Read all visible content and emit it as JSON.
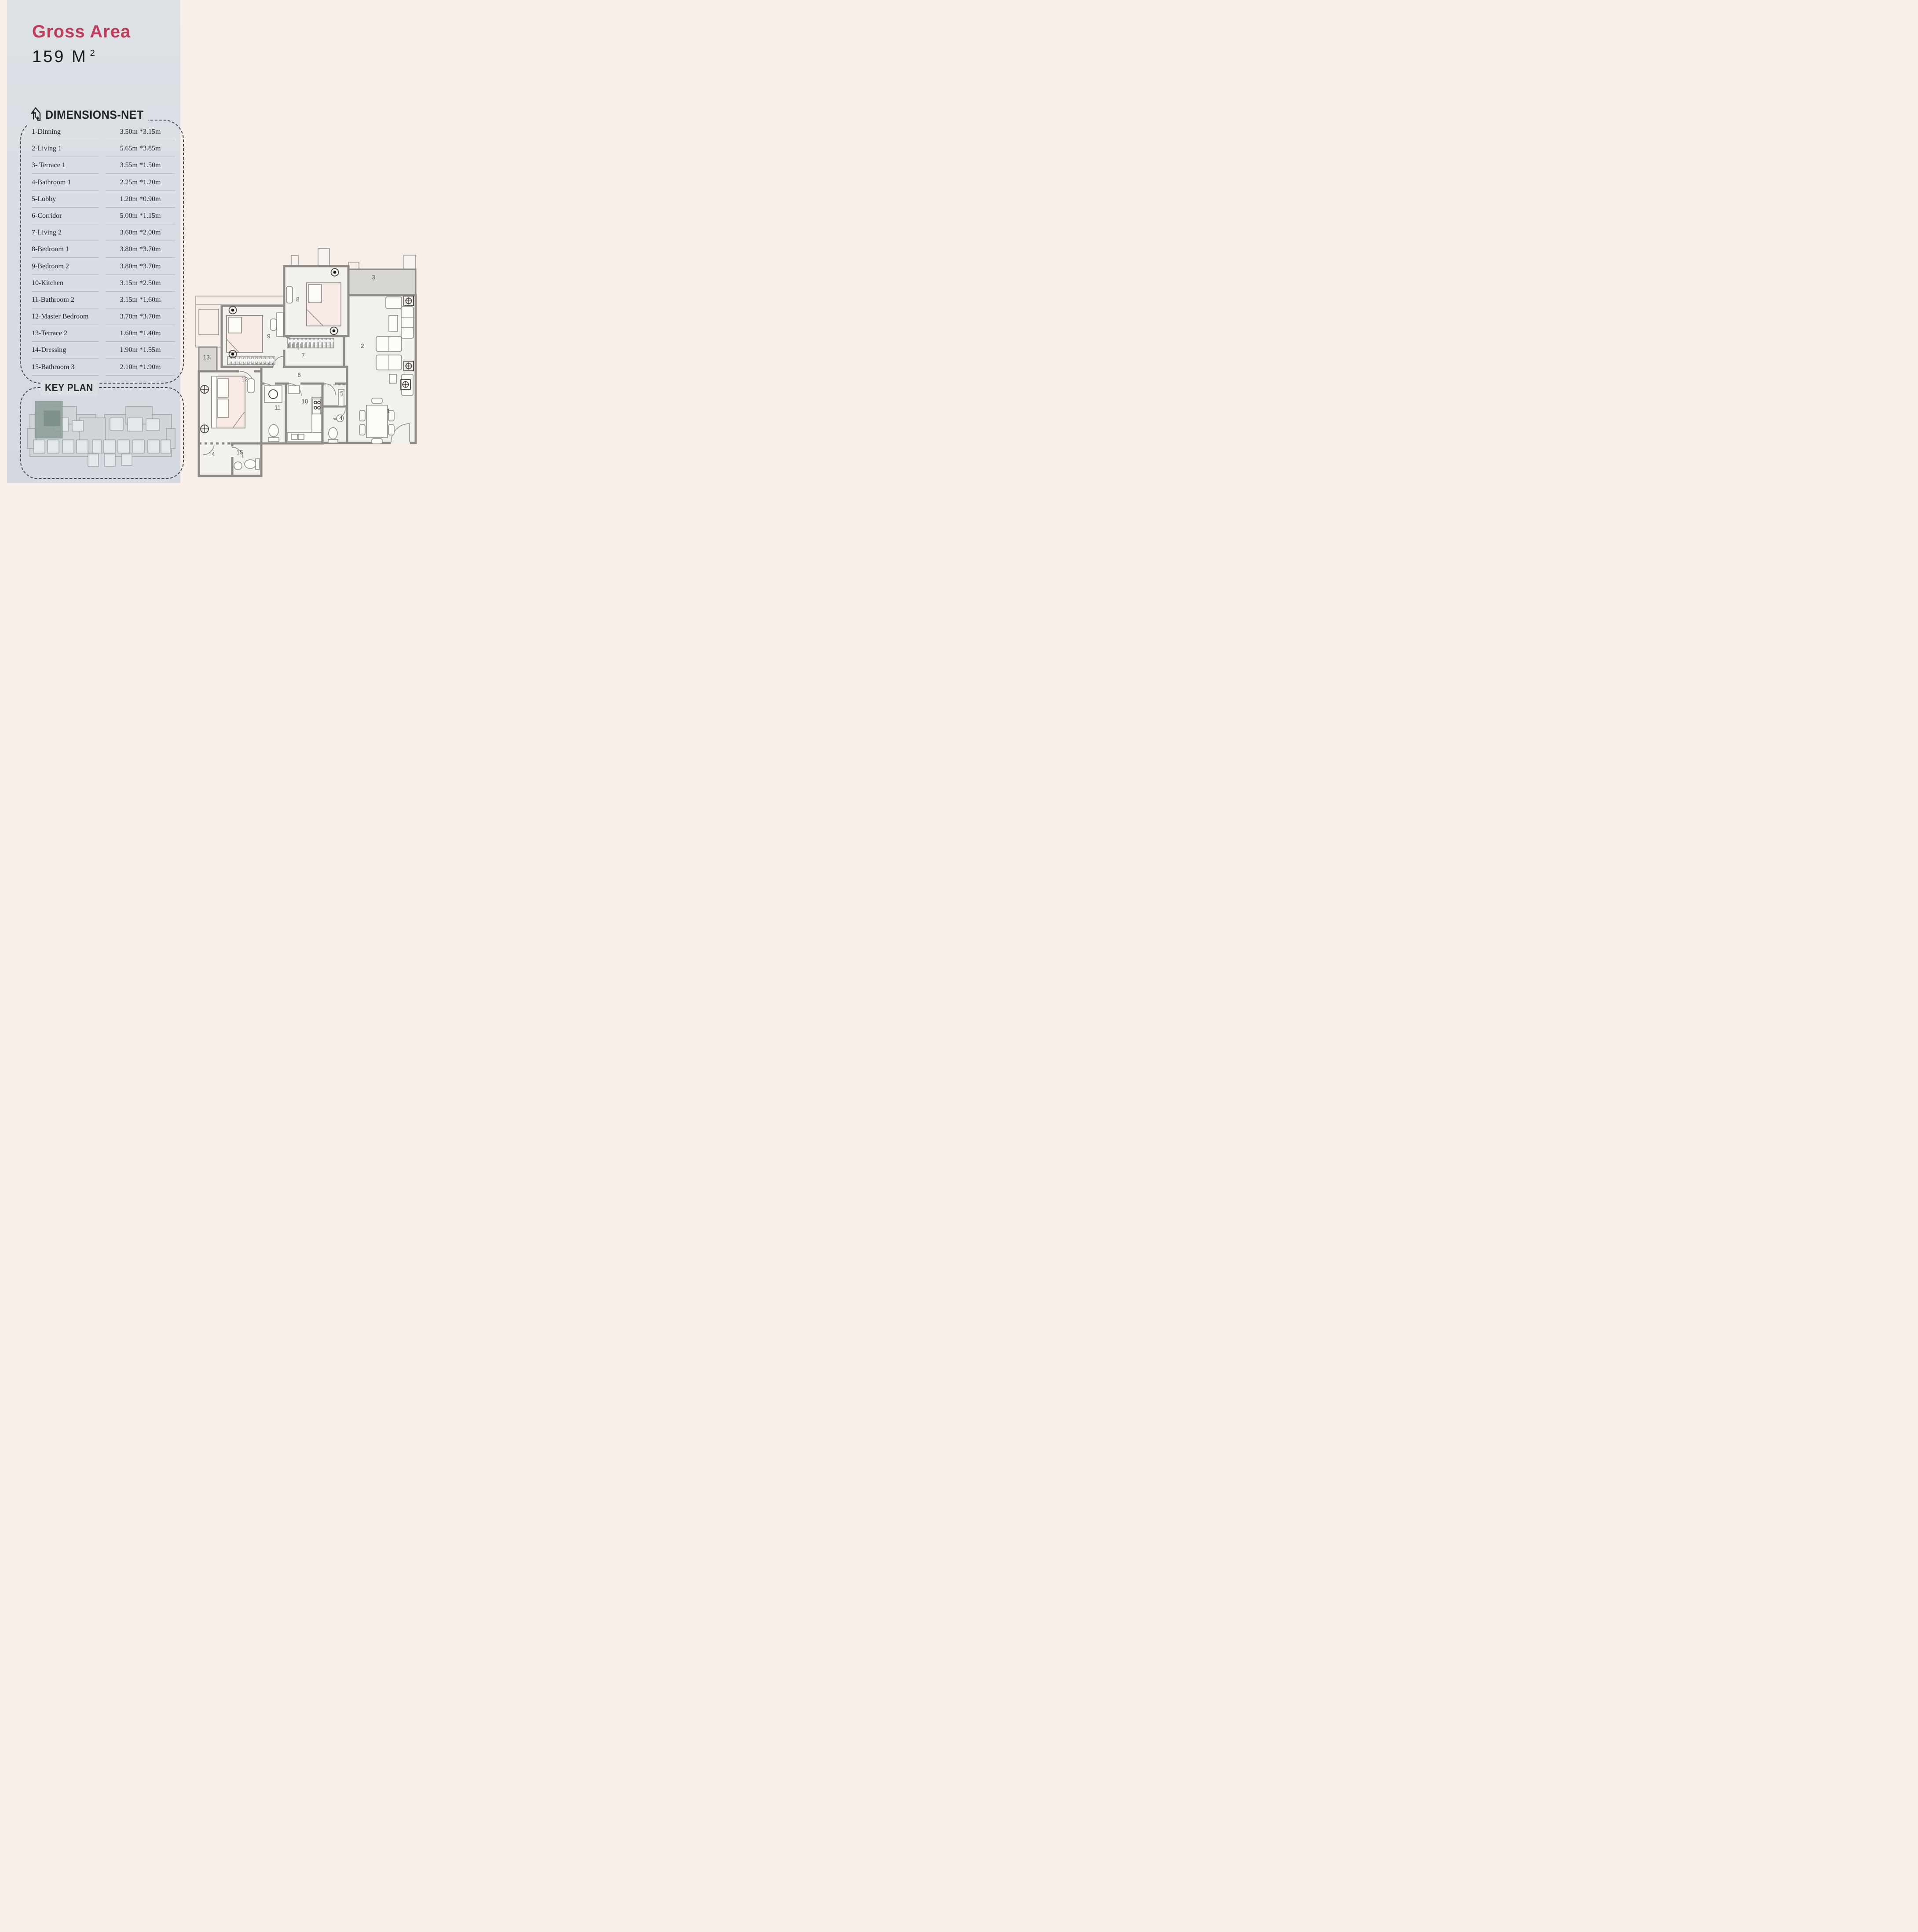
{
  "panel": {
    "title": "Gross Area",
    "area": {
      "value": "159 M",
      "sup": "2"
    },
    "dimensions": {
      "heading": "DIMENSIONS-NET",
      "rows": [
        {
          "name": "1-Dinning",
          "dims": "3.50m *3.15m"
        },
        {
          "name": "2-Living 1",
          "dims": "5.65m *3.85m"
        },
        {
          "name": "3- Terrace 1",
          "dims": "3.55m *1.50m"
        },
        {
          "name": "4-Bathroom 1",
          "dims": "2.25m *1.20m"
        },
        {
          "name": "5-Lobby",
          "dims": "1.20m *0.90m"
        },
        {
          "name": "6-Corridor",
          "dims": "5.00m *1.15m"
        },
        {
          "name": "7-Living 2",
          "dims": "3.60m *2.00m"
        },
        {
          "name": "8-Bedroom 1",
          "dims": "3.80m *3.70m"
        },
        {
          "name": "9-Bedroom 2",
          "dims": "3.80m *3.70m"
        },
        {
          "name": "10-Kitchen",
          "dims": "3.15m *2.50m"
        },
        {
          "name": "11-Bathroom 2",
          "dims": "3.15m *1.60m"
        },
        {
          "name": "12-Master Bedroom",
          "dims": "3.70m *3.70m"
        },
        {
          "name": "13-Terrace 2",
          "dims": "1.60m *1.40m"
        },
        {
          "name": "14-Dressing",
          "dims": "1.90m *1.55m"
        },
        {
          "name": "15-Bathroom 3",
          "dims": "2.10m *1.90m"
        }
      ]
    },
    "key_plan": {
      "heading": "KEY PLAN"
    }
  },
  "plan": {
    "rooms": [
      "1",
      "2",
      "3",
      "4",
      "5",
      "6",
      "7",
      "8",
      "9",
      "10",
      "11",
      "12",
      "13.",
      "14",
      "15"
    ]
  },
  "colors": {
    "accent_red": "#c23b58",
    "panel_background": "#d9dee4",
    "page_background": "#f9efe9",
    "wall_gray": "#8d8a87",
    "terrace_gray": "#d8d6d2",
    "keyplan_highlight": "#8fa09c"
  }
}
